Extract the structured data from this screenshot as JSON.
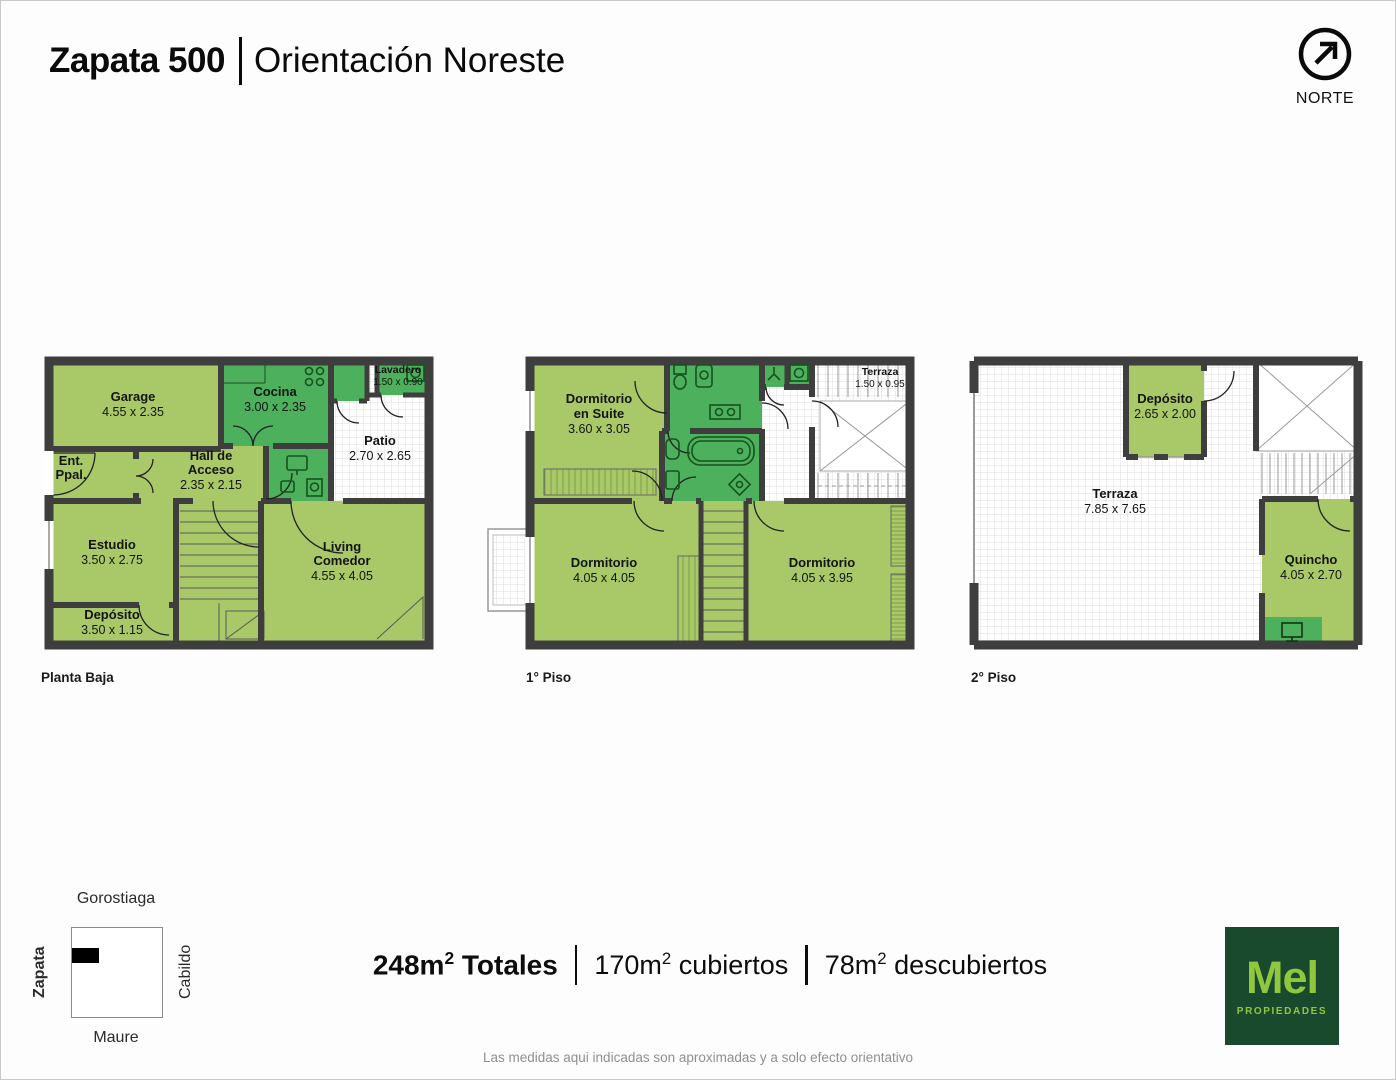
{
  "header": {
    "title": "Zapata 500",
    "subtitle": "Orientación Noreste",
    "north_label": "NORTE"
  },
  "floors": [
    {
      "label": "Planta Baja",
      "rooms": [
        {
          "name": "Garage",
          "dims": "4.55 x 2.35",
          "lines": [
            "Garage"
          ]
        },
        {
          "name": "Cocina",
          "dims": "3.00 x 2.35",
          "lines": [
            "Cocina"
          ]
        },
        {
          "name": "Lavadero",
          "dims": "1.50 x 0.90",
          "lines": [
            "Lavadero"
          ]
        },
        {
          "name": "Patio",
          "dims": "2.70 x 2.65",
          "lines": [
            "Patio"
          ]
        },
        {
          "name": "Ent. Ppal.",
          "dims": "",
          "lines": [
            "Ent.",
            "Ppal."
          ]
        },
        {
          "name": "Hall de Acceso",
          "dims": "2.35 x 2.15",
          "lines": [
            "Hall de",
            "Acceso"
          ]
        },
        {
          "name": "Estudio",
          "dims": "3.50 x 2.75",
          "lines": [
            "Estudio"
          ]
        },
        {
          "name": "Depósito",
          "dims": "3.50 x 1.15",
          "lines": [
            "Depósito"
          ]
        },
        {
          "name": "Living Comedor",
          "dims": "4.55 x 4.05",
          "lines": [
            "Living",
            "Comedor"
          ]
        }
      ]
    },
    {
      "label": "1° Piso",
      "rooms": [
        {
          "name": "Dormitorio en Suite",
          "dims": "3.60 x 3.05",
          "lines": [
            "Dormitorio",
            "en Suite"
          ]
        },
        {
          "name": "Terraza",
          "dims": "1.50 x 0.95",
          "lines": [
            "Terraza"
          ]
        },
        {
          "name": "Dormitorio",
          "dims": "4.05 x 4.05",
          "lines": [
            "Dormitorio"
          ]
        },
        {
          "name": "Dormitorio",
          "dims": "4.05 x 3.95",
          "lines": [
            "Dormitorio"
          ]
        }
      ]
    },
    {
      "label": "2° Piso",
      "rooms": [
        {
          "name": "Depósito",
          "dims": "2.65 x 2.00",
          "lines": [
            "Depósito"
          ]
        },
        {
          "name": "Terraza",
          "dims": "7.85 x 7.65",
          "lines": [
            "Terraza"
          ]
        },
        {
          "name": "Quincho",
          "dims": "4.05 x 2.70",
          "lines": [
            "Quincho"
          ]
        }
      ]
    }
  ],
  "totals": {
    "total_num": "248m",
    "total_sup": "2",
    "total_label": " Totales",
    "covered_num": "170m",
    "covered_sup": "2",
    "covered_label": " cubiertos",
    "uncovered_num": "78m",
    "uncovered_sup": "2",
    "uncovered_label": " descubiertos"
  },
  "location_map": {
    "street_top": "Gorostiaga",
    "street_right": "Cabildo",
    "street_bottom": "Maure",
    "street_left": "Zapata"
  },
  "logo": {
    "brand": "Mel",
    "tagline": "PROPIEDADES"
  },
  "disclaimer": "Las medidas aqui indicadas son aproximadas y a solo efecto orientativo",
  "colors": {
    "room_light": "#a9c868",
    "room_wet": "#4cb05c",
    "wall": "#3e3e3e",
    "logo_bg": "#1a4a2d",
    "logo_text": "#8fc73e"
  }
}
